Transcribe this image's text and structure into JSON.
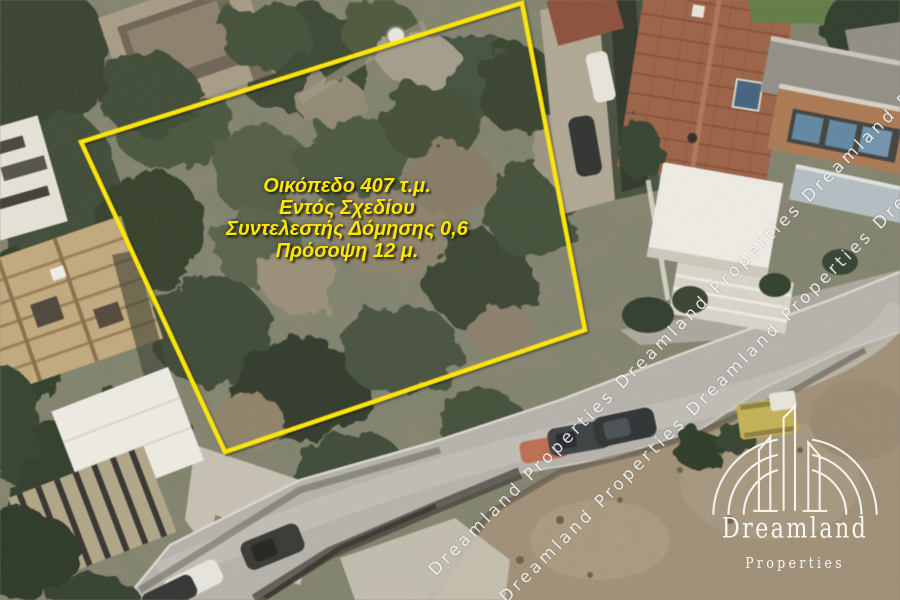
{
  "annotation": {
    "lines": [
      "Οικόπεδο 407 τ.μ.",
      "Εντός Σχεδίου",
      "Συντελεστής Δόμησης 0,6",
      "Πρόσοψη 12 μ."
    ],
    "color": "#ffe600"
  },
  "boundary": {
    "color": "#ffe600"
  },
  "watermark": {
    "color": "#ffffff",
    "stripe1": "Dreamland Properties Dreamland Properties Dreamland Pro",
    "stripe2": "Dreamland Properties Dreamland Properties Dream"
  },
  "logo": {
    "name": "Dreamland",
    "subtitle": "Properties",
    "color": "#ffffff"
  }
}
